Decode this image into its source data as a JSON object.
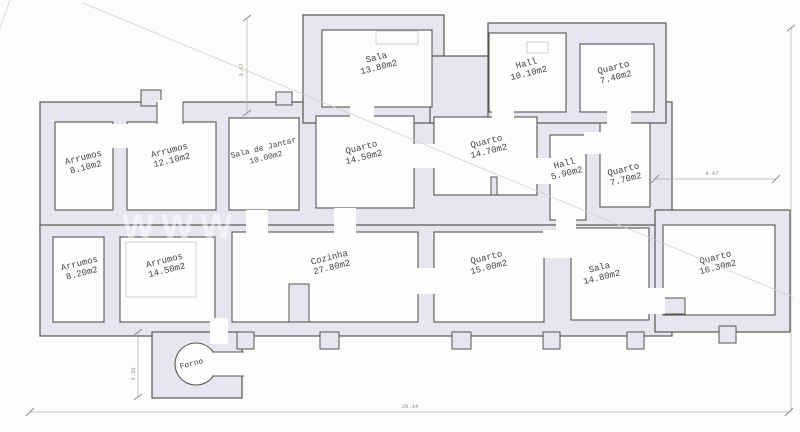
{
  "rooms": [
    {
      "name": "Sala",
      "area": "13.80m2"
    },
    {
      "name": "Hall",
      "area": "10.10m2"
    },
    {
      "name": "Quarto",
      "area": "7.40m2"
    },
    {
      "name": "Arrumos",
      "area": "8.10m2"
    },
    {
      "name": "Arrumos",
      "area": "12.10m2"
    },
    {
      "name": "Sala de Jantar",
      "area": "10.00m2"
    },
    {
      "name": "Quarto",
      "area": "14.50m2"
    },
    {
      "name": "Quarto",
      "area": "14.70m2"
    },
    {
      "name": "Hall",
      "area": "5.90m2"
    },
    {
      "name": "Quarto",
      "area": "7.70m2"
    },
    {
      "name": "Arrumos",
      "area": "8.20m2"
    },
    {
      "name": "Arrumos",
      "area": "14.50m2"
    },
    {
      "name": "Cozinha",
      "area": "27.80m2"
    },
    {
      "name": "Quarto",
      "area": "15.00m2"
    },
    {
      "name": "Sala",
      "area": "14.80m2"
    },
    {
      "name": "Quarto",
      "area": "16.30m2"
    },
    {
      "name": "Forno",
      "area": ""
    }
  ],
  "dimensions": {
    "top_vertical": "3.67",
    "right_horizontal": "4.67",
    "forno_vertical": "3.35",
    "bottom_horizontal": "29.14"
  },
  "watermark": "WWW",
  "colors": {
    "wall_fill": "#e7e5f0",
    "wall_line": "#5a5551",
    "dimension_line": "#b3afac",
    "background": "#fcfcfa"
  }
}
